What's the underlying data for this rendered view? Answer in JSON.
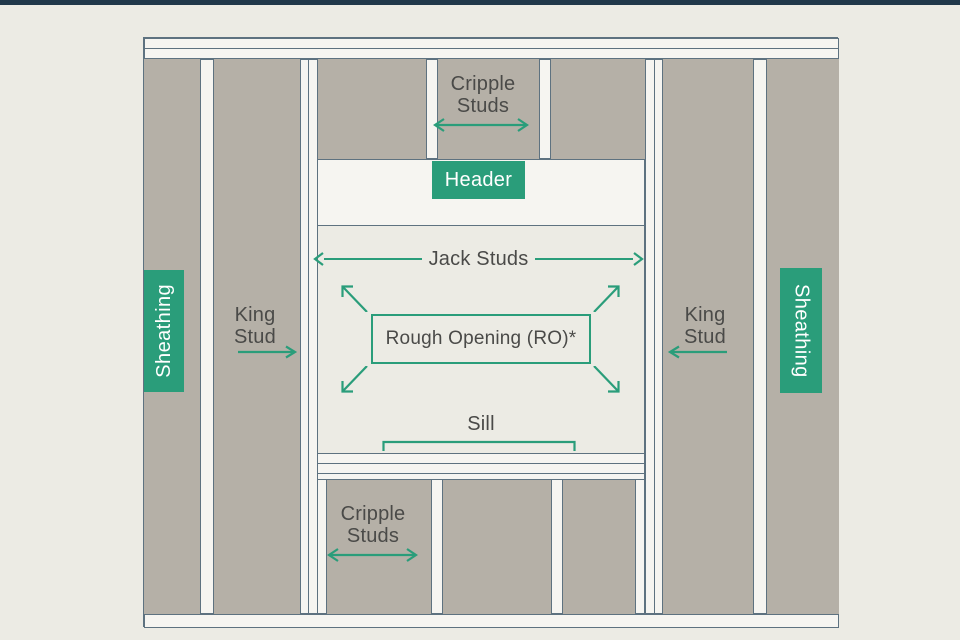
{
  "colors": {
    "background": "#ECEBE4",
    "top_bar": "#21384A",
    "lumber_white": "#F6F5F1",
    "panel_gray": "#B5B0A7",
    "accent_green": "#2A9D7A",
    "label_text": "#4A4A48",
    "member_outline": "#5E7280"
  },
  "labels": {
    "cripple_top": {
      "line1": "Cripple",
      "line2": "Studs"
    },
    "header": "Header",
    "jack_studs": "Jack Studs",
    "rough_opening": "Rough Opening (RO)*",
    "sill": "Sill",
    "cripple_bottom": {
      "line1": "Cripple",
      "line2": "Studs"
    },
    "king_left": {
      "line1": "King",
      "line2": "Stud"
    },
    "king_right": {
      "line1": "King",
      "line2": "Stud"
    },
    "sheathing_left": "Sheathing",
    "sheathing_right": "Sheathing"
  }
}
